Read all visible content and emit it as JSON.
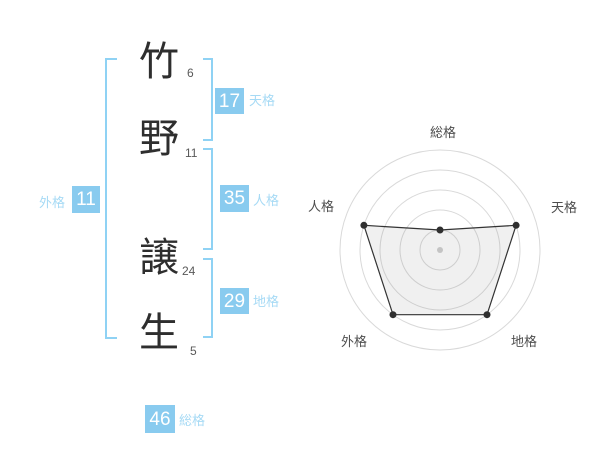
{
  "name_diagram": {
    "characters": [
      {
        "char": "竹",
        "strokes": "6"
      },
      {
        "char": "野",
        "strokes": "11"
      },
      {
        "char": "譲",
        "strokes": "24"
      },
      {
        "char": "生",
        "strokes": "5"
      }
    ],
    "fortunes": {
      "tenkaku": {
        "label": "天格",
        "value": "17"
      },
      "jinkaku": {
        "label": "人格",
        "value": "35"
      },
      "chikaku": {
        "label": "地格",
        "value": "29"
      },
      "gaikaku": {
        "label": "外格",
        "value": "11"
      },
      "soukaku": {
        "label": "総格",
        "value": "46"
      }
    }
  },
  "colors": {
    "value_box_blue": "#89cbef",
    "kaku_label_blue": "#a6daf5",
    "bracket_blue": "#8fd2f4",
    "text_dark": "#2e2e2e",
    "radar_grid": "#d9d9d9",
    "radar_stroke": "#333333"
  },
  "chart_data": {
    "type": "radar",
    "axes": [
      "総格",
      "天格",
      "地格",
      "外格",
      "人格"
    ],
    "kaku_values": {
      "総格": 46,
      "天格": 17,
      "地格": 29,
      "外格": 11,
      "人格": 35
    },
    "plotted_levels": {
      "総格": 1,
      "天格": 4,
      "地格": 4,
      "外格": 4,
      "人格": 4
    },
    "scale_max": 5,
    "rings": 5,
    "legend": "none",
    "grid": "circular"
  }
}
